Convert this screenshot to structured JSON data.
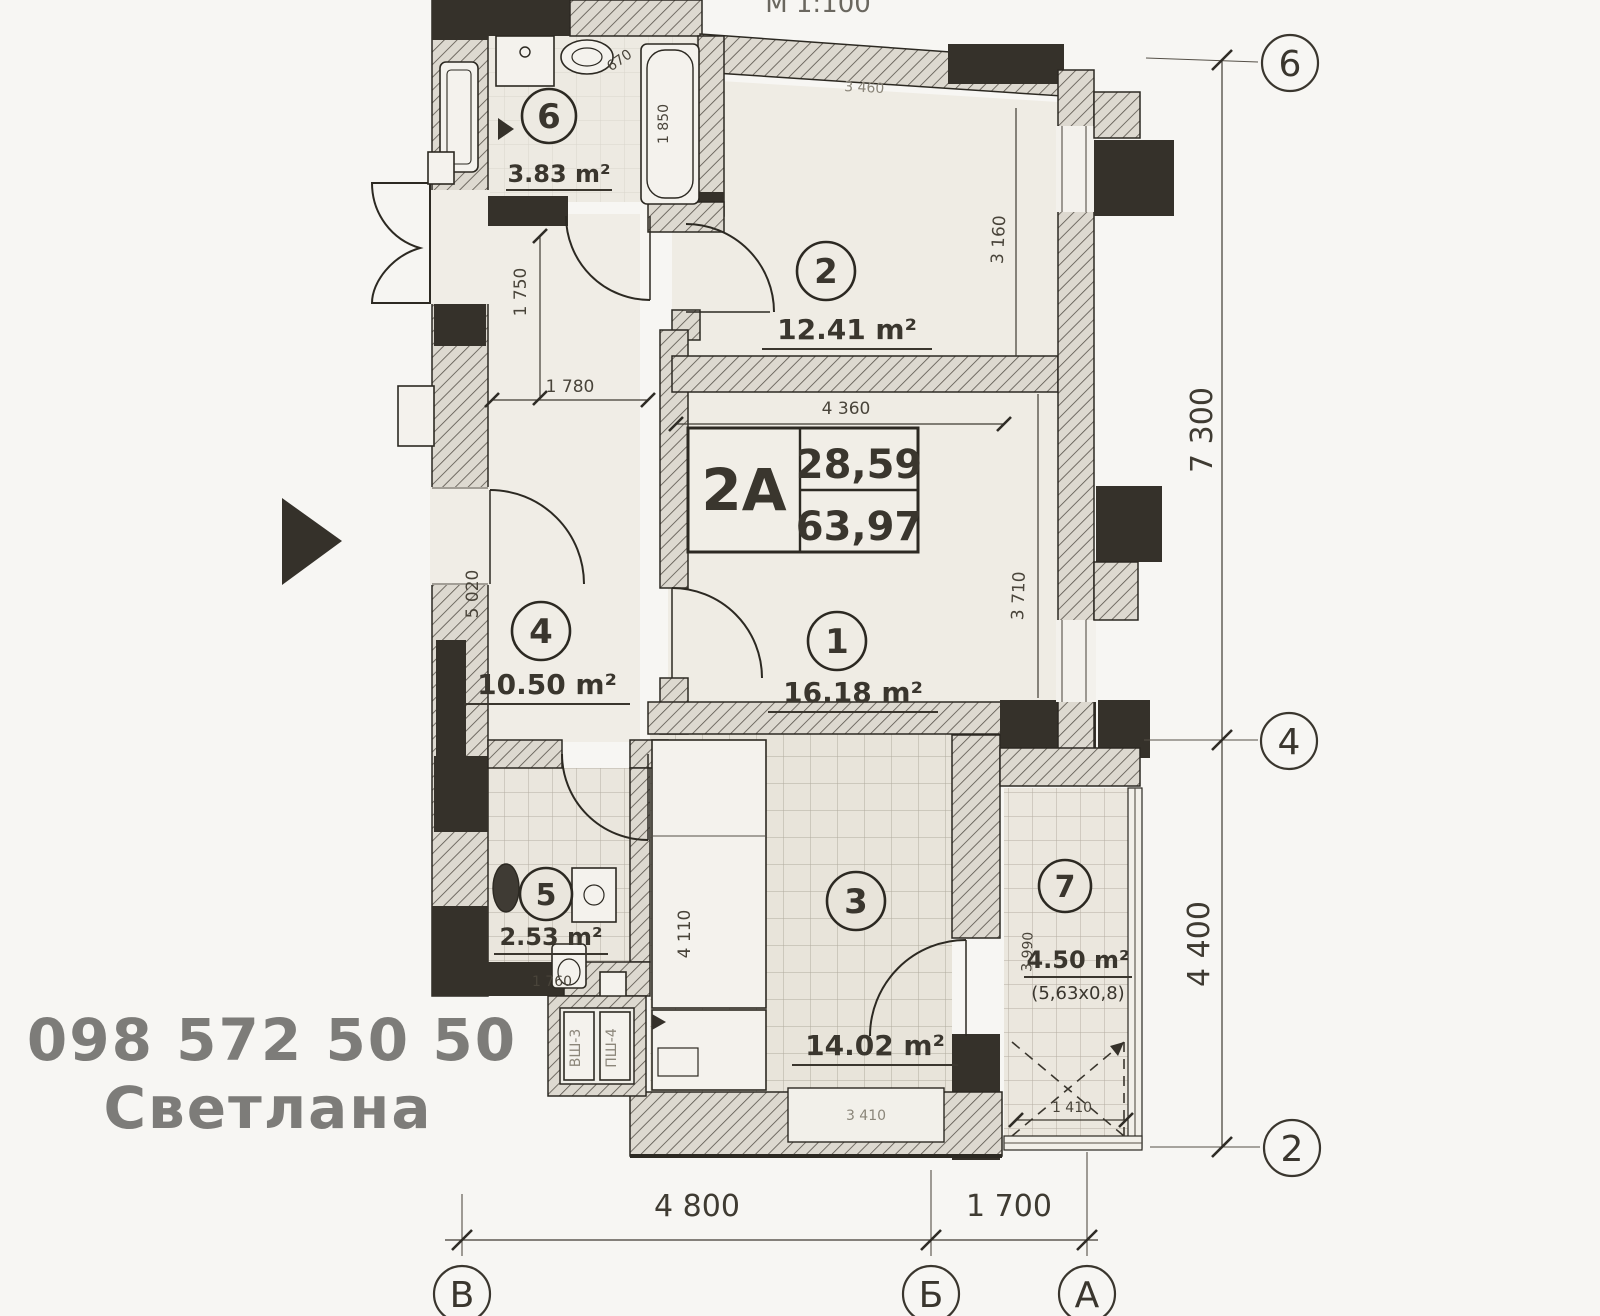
{
  "scale_note": "М 1:100",
  "apartment": {
    "type": "2A",
    "living_area": "28,59",
    "total_area": "63,97"
  },
  "rooms": {
    "r1": {
      "number": "1",
      "area": "16.18 m²"
    },
    "r2": {
      "number": "2",
      "area": "12.41 m²"
    },
    "r3": {
      "number": "3",
      "area": "14.02 m²"
    },
    "r4": {
      "number": "4",
      "area": "10.50 m²"
    },
    "r5": {
      "number": "5",
      "area": "2.53 m²"
    },
    "r6": {
      "number": "6",
      "area": "3.83 m²"
    },
    "r7": {
      "number": "7",
      "area": "4.50 m²",
      "note": "(5,63x0,8)"
    }
  },
  "dimensions": {
    "d1750": "1 750",
    "d1780": "1 780",
    "d3460": "3 460",
    "d3160": "3 160",
    "d4360": "4 360",
    "d3710": "3 710",
    "d5020": "5 020",
    "d4110": "4 110",
    "d1760": "1 760",
    "d1850": "1 850",
    "d670": "670",
    "d3990": "3 990",
    "d1410": "1 410",
    "d3410": "3 410"
  },
  "axis_grid": {
    "right_labels": [
      "6",
      "4",
      "2"
    ],
    "right_spans": [
      "7 300",
      "4 400"
    ],
    "bottom_labels": [
      "В",
      "Б",
      "А"
    ],
    "bottom_spans": [
      "4 800",
      "1 700"
    ]
  },
  "shaft_labels": [
    "ВШ-3",
    "ПШ-4"
  ],
  "watermark": {
    "phone": "098 572 50 50",
    "name": "Светлана"
  }
}
